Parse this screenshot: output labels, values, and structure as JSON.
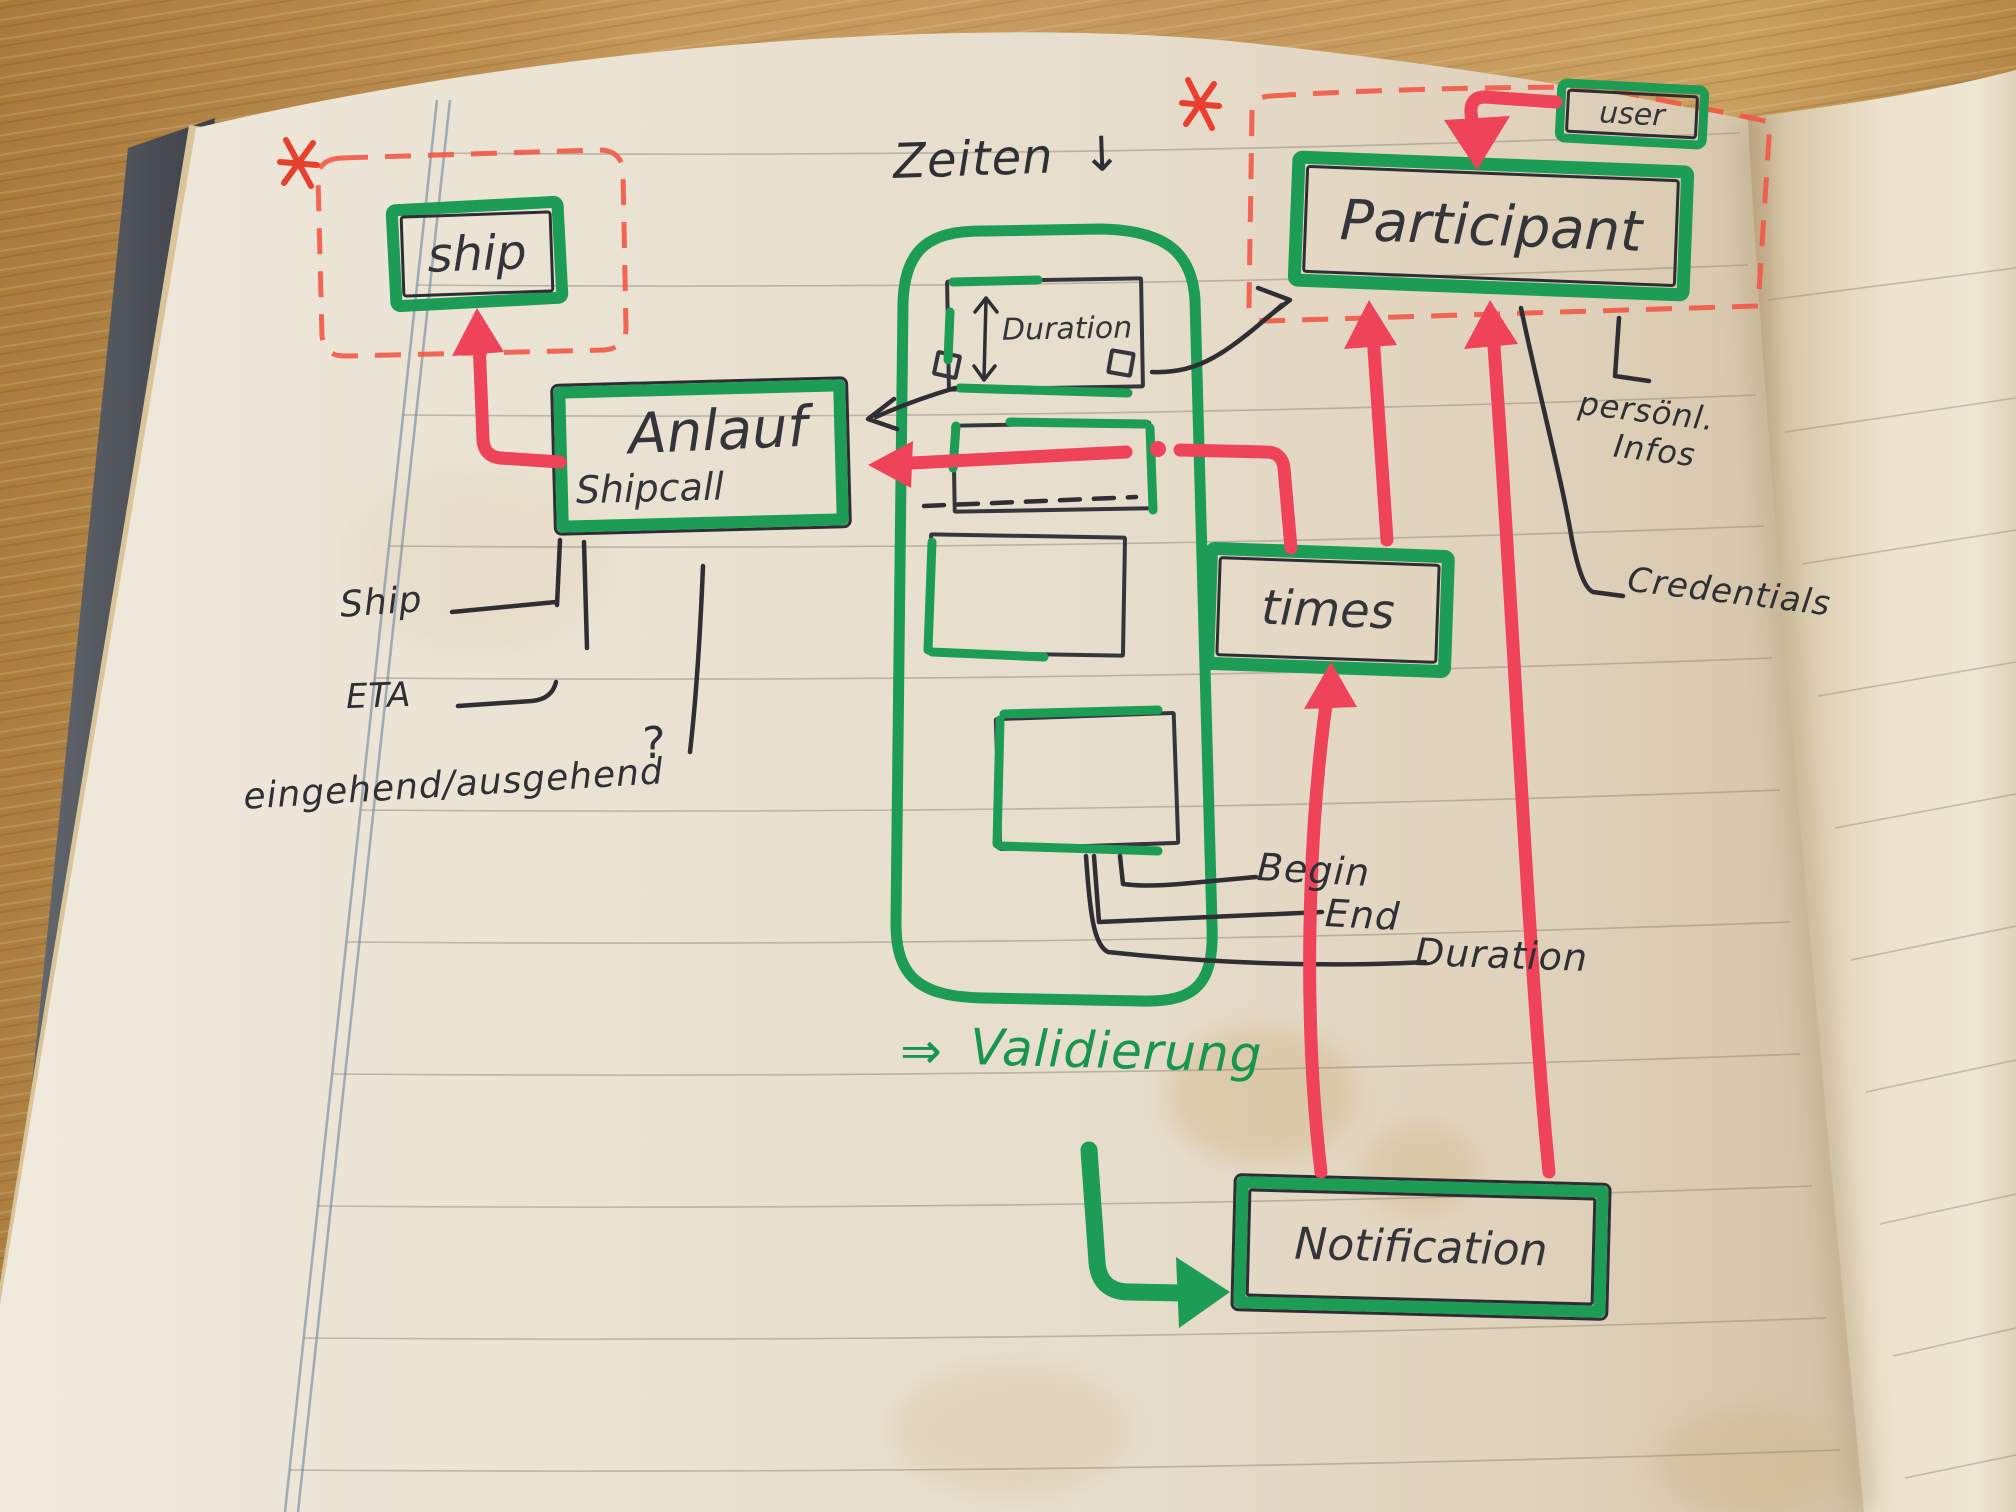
{
  "colors": {
    "marker_green": "#1c9c55",
    "marker_red": "#ee4358",
    "pen_black": "#2e2e33",
    "dashed_red": "#f25847",
    "page": "#e9e1d2"
  },
  "nodes": {
    "ship": {
      "label": "ship"
    },
    "anlauf": {
      "label": "Anlauf",
      "sublabel": "Shipcall"
    },
    "participant": {
      "label": "Participant"
    },
    "user": {
      "label": "user"
    },
    "times": {
      "label": "times"
    },
    "notification": {
      "label": "Notification"
    },
    "duration": {
      "label": "Duration"
    }
  },
  "annotations": {
    "zeiten": {
      "label": "Zeiten",
      "arrow": "↓"
    },
    "ship_attr": "Ship",
    "eta": "ETA",
    "in_out": "eingehend/ausgehend",
    "question_mark": "?",
    "begin": "Begin",
    "end": "End",
    "duration": "Duration",
    "personal_line1": "persönl.",
    "personal_line2": "Infos",
    "credentials": "Credentials",
    "validation_arrow": "⇒",
    "validation": "Validierung",
    "asterisk": "*"
  }
}
